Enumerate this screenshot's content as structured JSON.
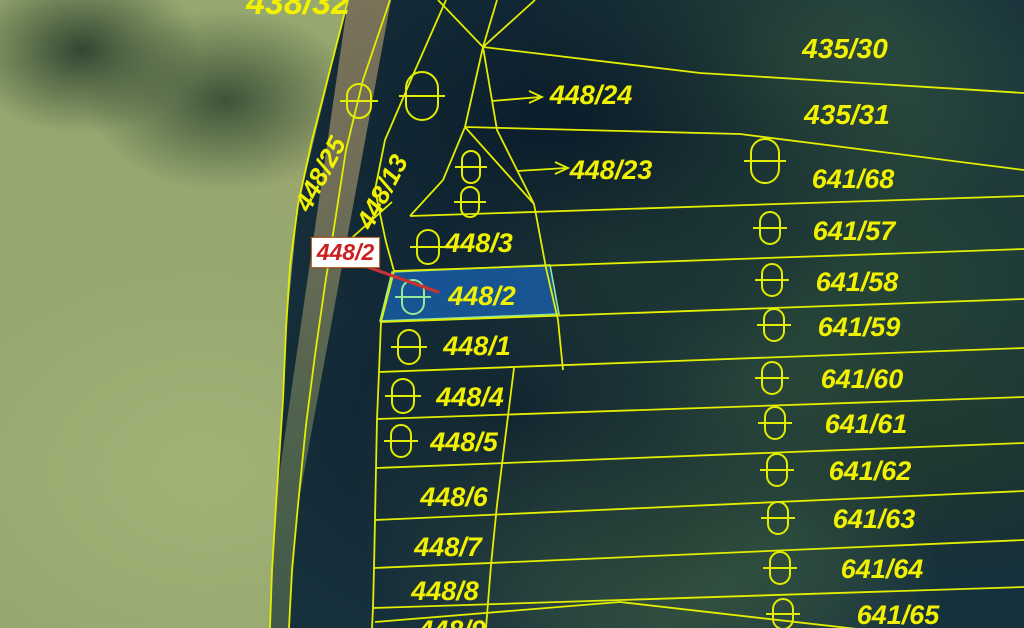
{
  "map": {
    "type": "cadastral-parcel-map-on-aerial-imagery",
    "colors": {
      "line": "#e3ed00",
      "label": "#f2f200",
      "highlight_fill": "#1f62a8",
      "highlight_stroke": "#8ee6a0",
      "highlight_text": "#96e896",
      "callout_text": "#cc1f1f",
      "callout_bg": "#ffffff",
      "callout_leader": "#c73333"
    },
    "labels": [
      {
        "id": "438-32",
        "text": "438/32",
        "x": 298,
        "y": 14,
        "size": 34
      },
      {
        "id": "435-30",
        "text": "435/30",
        "x": 845,
        "y": 58,
        "size": 28
      },
      {
        "id": "435-31",
        "text": "435/31",
        "x": 847,
        "y": 124,
        "size": 28
      },
      {
        "id": "448-24",
        "text": "448/24",
        "x": 591,
        "y": 104,
        "size": 27
      },
      {
        "id": "448-23",
        "text": "448/23",
        "x": 611,
        "y": 179,
        "size": 27
      },
      {
        "id": "448-25",
        "text": "448/25",
        "x": 328,
        "y": 178,
        "size": 26,
        "rotate": -62
      },
      {
        "id": "448-13",
        "text": "448/13",
        "x": 390,
        "y": 196,
        "size": 26,
        "rotate": -62
      },
      {
        "id": "448-3",
        "text": "448/3",
        "x": 479,
        "y": 252,
        "size": 27
      },
      {
        "id": "448-2",
        "text": "448/2",
        "x": 482,
        "y": 305,
        "size": 27,
        "color": "#96e896"
      },
      {
        "id": "448-1",
        "text": "448/1",
        "x": 477,
        "y": 355,
        "size": 27
      },
      {
        "id": "448-4",
        "text": "448/4",
        "x": 470,
        "y": 406,
        "size": 27
      },
      {
        "id": "448-5",
        "text": "448/5",
        "x": 464,
        "y": 451,
        "size": 27
      },
      {
        "id": "448-6",
        "text": "448/6",
        "x": 454,
        "y": 506,
        "size": 27
      },
      {
        "id": "448-7",
        "text": "448/7",
        "x": 448,
        "y": 556,
        "size": 27
      },
      {
        "id": "448-8",
        "text": "448/8",
        "x": 445,
        "y": 600,
        "size": 27
      },
      {
        "id": "448-9",
        "text": "448/9",
        "x": 452,
        "y": 639,
        "size": 27
      },
      {
        "id": "641-68",
        "text": "641/68",
        "x": 853,
        "y": 188,
        "size": 27
      },
      {
        "id": "641-57",
        "text": "641/57",
        "x": 854,
        "y": 240,
        "size": 27
      },
      {
        "id": "641-58",
        "text": "641/58",
        "x": 857,
        "y": 291,
        "size": 27
      },
      {
        "id": "641-59",
        "text": "641/59",
        "x": 859,
        "y": 336,
        "size": 27
      },
      {
        "id": "641-60",
        "text": "641/60",
        "x": 862,
        "y": 388,
        "size": 27
      },
      {
        "id": "641-61",
        "text": "641/61",
        "x": 866,
        "y": 433,
        "size": 27
      },
      {
        "id": "641-62",
        "text": "641/62",
        "x": 870,
        "y": 480,
        "size": 27
      },
      {
        "id": "641-63",
        "text": "641/63",
        "x": 874,
        "y": 528,
        "size": 27
      },
      {
        "id": "641-64",
        "text": "641/64",
        "x": 882,
        "y": 578,
        "size": 27
      },
      {
        "id": "641-65",
        "text": "641/65",
        "x": 898,
        "y": 624,
        "size": 27
      }
    ],
    "boundary_lines": [
      {
        "id": "path-left",
        "points": "348,0 330,70 312,140 298,205 290,265 286,330 283,400 277,490 272,570 270,628"
      },
      {
        "id": "path-right",
        "points": "390,0 363,80 346,150 336,215 325,285 315,355 306,425 298,505 292,570 289,628"
      },
      {
        "id": "spur",
        "points": "392,202 336,252"
      },
      {
        "id": "column-left",
        "points": "446,0 413,75 385,140 375,190 386,242 394,271 381,322 379,372 377,419 376,468 375,520 374,568 373,608 372,628"
      },
      {
        "id": "divider-upper",
        "points": "483,47 497,130 534,204 546,268 558,320 563,370"
      },
      {
        "id": "divider-lower",
        "points": "514,368 505,440 497,505 491,565 486,628"
      },
      {
        "id": "fan-1",
        "points": "438,0 483,47"
      },
      {
        "id": "fan-2",
        "points": "497,0 483,47"
      },
      {
        "id": "fan-3",
        "points": "535,0 483,47"
      },
      {
        "id": "node-up",
        "points": "465,127 483,47"
      },
      {
        "id": "node-right",
        "points": "465,127 534,204"
      },
      {
        "id": "node-left",
        "points": "465,127 443,180 410,216"
      },
      {
        "id": "north-boundary",
        "points": "483,47 700,73 1024,93"
      },
      {
        "id": "forest-boundary",
        "points": "465,127 740,134 1024,170"
      },
      {
        "id": "strip-1",
        "points": "410,216 1024,196"
      },
      {
        "id": "strip-2",
        "points": "394,271 1024,249"
      },
      {
        "id": "strip-3",
        "points": "381,322 1024,299"
      },
      {
        "id": "strip-4",
        "points": "379,372 1024,348"
      },
      {
        "id": "strip-5",
        "points": "377,419 1024,397"
      },
      {
        "id": "strip-6",
        "points": "376,468 1024,443"
      },
      {
        "id": "strip-7",
        "points": "375,520 1024,491"
      },
      {
        "id": "strip-8",
        "points": "374,568 1024,540"
      },
      {
        "id": "strip-9",
        "points": "373,608 1024,587"
      },
      {
        "id": "strip-10",
        "points": "375,622 620,602 1024,648"
      }
    ],
    "ovals": [
      {
        "x": 359,
        "y": 101,
        "w": 24,
        "h": 34
      },
      {
        "x": 422,
        "y": 96,
        "w": 32,
        "h": 48
      },
      {
        "x": 471,
        "y": 167,
        "w": 18,
        "h": 32
      },
      {
        "x": 470,
        "y": 202,
        "w": 18,
        "h": 30
      },
      {
        "x": 765,
        "y": 161,
        "w": 28,
        "h": 44
      },
      {
        "x": 428,
        "y": 247,
        "w": 22,
        "h": 34
      },
      {
        "x": 413,
        "y": 297,
        "w": 22,
        "h": 34,
        "green": true
      },
      {
        "x": 409,
        "y": 347,
        "w": 22,
        "h": 34
      },
      {
        "x": 403,
        "y": 396,
        "w": 22,
        "h": 34
      },
      {
        "x": 401,
        "y": 441,
        "w": 20,
        "h": 32
      },
      {
        "x": 770,
        "y": 228,
        "w": 20,
        "h": 32
      },
      {
        "x": 772,
        "y": 280,
        "w": 20,
        "h": 32
      },
      {
        "x": 774,
        "y": 325,
        "w": 20,
        "h": 32
      },
      {
        "x": 772,
        "y": 378,
        "w": 20,
        "h": 32
      },
      {
        "x": 775,
        "y": 423,
        "w": 20,
        "h": 32
      },
      {
        "x": 777,
        "y": 470,
        "w": 20,
        "h": 32
      },
      {
        "x": 778,
        "y": 518,
        "w": 20,
        "h": 32
      },
      {
        "x": 780,
        "y": 568,
        "w": 20,
        "h": 32
      },
      {
        "x": 783,
        "y": 614,
        "w": 20,
        "h": 30
      }
    ],
    "arrows": [
      {
        "id": "arrow-448-24",
        "x1": 492,
        "y1": 101,
        "x2": 540,
        "y2": 97
      },
      {
        "id": "arrow-448-23",
        "x1": 517,
        "y1": 171,
        "x2": 566,
        "y2": 168
      }
    ],
    "highlight_parcel": {
      "id": "448/2",
      "points": "392,272 550,265 559,314 380,321"
    },
    "callout": {
      "text": "448/2",
      "box": {
        "x": 311,
        "y": 237,
        "w": 67,
        "h": 29
      },
      "leader": {
        "x1": 365,
        "y1": 266,
        "x2": 438,
        "y2": 292
      }
    }
  }
}
